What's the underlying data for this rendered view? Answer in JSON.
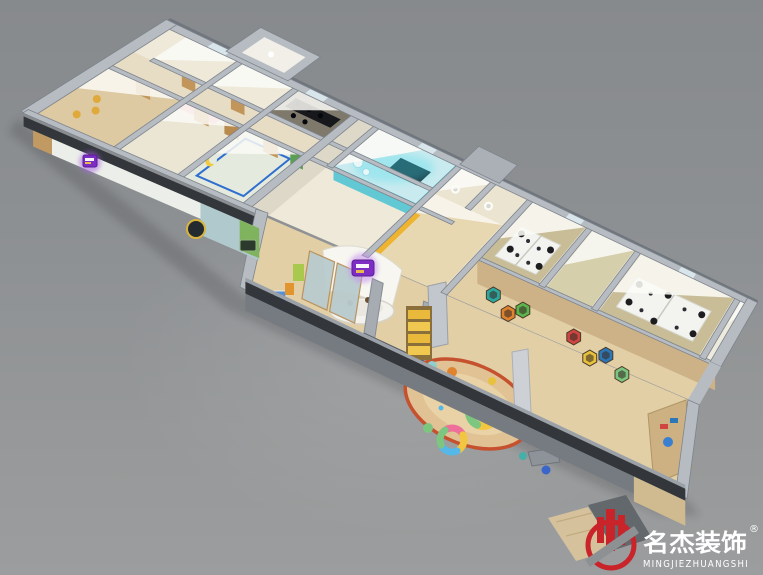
{
  "scene": {
    "description": "3D axonometric cutaway render of an early-education center interior on a gray backdrop",
    "palette": {
      "background": "#8e9193",
      "wall_top": "#b6bcc2",
      "wall_edge": "#7d848c",
      "wall_dark": "#33373c",
      "floor_wood": "#e2cfa6",
      "floor_beige": "#efe9da",
      "floor_khaki": "#c8bd96",
      "teal_glow": "#3fd9ea",
      "purple_sign": "#7d2cc4",
      "accent_yellow": "#eeb42f",
      "rug_border": "#c6512e",
      "chair_black": "#1d1d20",
      "exterior_white": "#eceeea",
      "exterior_teal": "#b0c9cc",
      "facade_green": "#7fb35e"
    },
    "areas": [
      {
        "name": "classroom-left",
        "floor_color": "#ddc9a2"
      },
      {
        "name": "classroom-pink",
        "floor_color": "#ebe5d3"
      },
      {
        "name": "moon-room",
        "floor_color": "#e4eadd"
      },
      {
        "name": "staff-office-dark",
        "floor_color": "#7f796c"
      },
      {
        "name": "corridor",
        "floor_color": "#e7dcc4"
      },
      {
        "name": "media-room-glowing",
        "floor_color": "#c9ebef"
      },
      {
        "name": "restrooms",
        "floor_color": "#ebe4d0"
      },
      {
        "name": "reception",
        "floor_color": "#e8d8b2"
      },
      {
        "name": "entrance",
        "floor_color": "#e2cfa6"
      },
      {
        "name": "office-1",
        "floor_color": "#c8bd96"
      },
      {
        "name": "office-2",
        "floor_color": "#c8bd96"
      },
      {
        "name": "play-area",
        "floor_color": "#e2cfa6"
      }
    ]
  },
  "watermark": {
    "brand_cn": "名杰装饰",
    "registered": "®",
    "brand_en": "MINGJIEZHUANGSHI",
    "logo_color": "#c8242a",
    "text_color": "#ffffff"
  }
}
